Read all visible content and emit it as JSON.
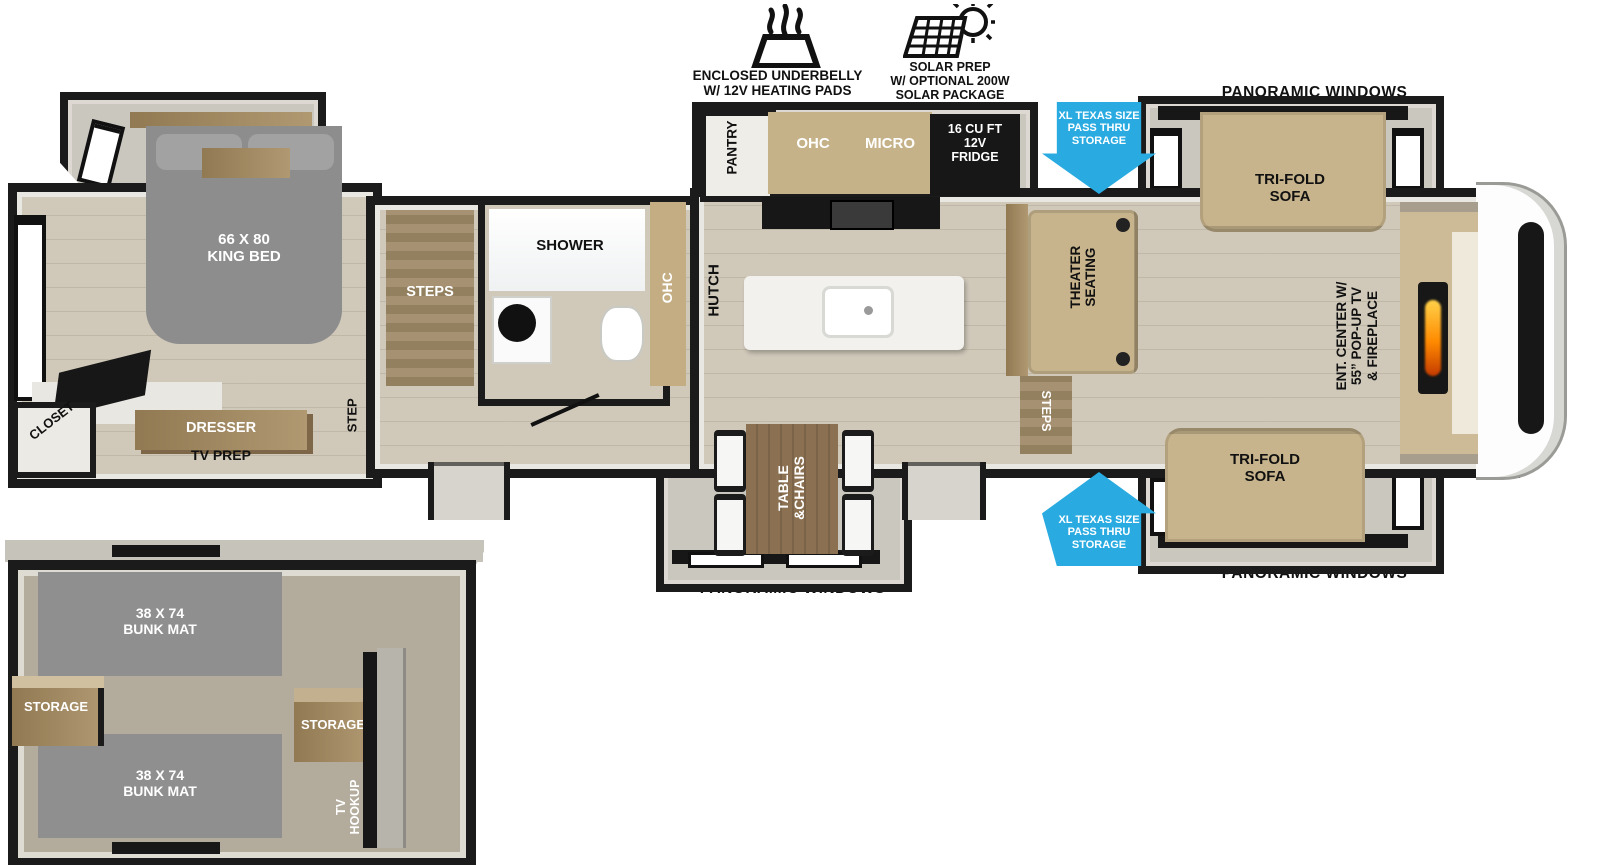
{
  "header": {
    "underbelly_label": "ENCLOSED UNDERBELLY\nW/ 12V HEATING PADS",
    "solar_label": "SOLAR PREP\nW/ OPTIONAL 200W\nSOLAR PACKAGE"
  },
  "callouts": {
    "pass_thru_top": "XL TEXAS SIZE\nPASS THRU\nSTORAGE",
    "pass_thru_bottom": "XL TEXAS SIZE\nPASS THRU\nSTORAGE",
    "panoramic_windows_top": "PANORAMIC WINDOWS",
    "panoramic_windows_bottom_right": "PANORAMIC WINDOWS",
    "panoramic_windows_dinette": "PANORAMIC WINDOWS"
  },
  "living": {
    "sofa_top": "TRI-FOLD\nSOFA",
    "sofa_bottom": "TRI-FOLD\nSOFA",
    "theater_seating": "THEATER\nSEATING",
    "steps": "STEPS",
    "ent_center": "ENT. CENTER W/\n55” POP-UP TV\n& FIREPLACE"
  },
  "kitchen": {
    "pantry": "PANTRY",
    "ohc": "OHC",
    "micro": "MICRO",
    "fridge": "16 CU FT\n12V\nFRIDGE",
    "hutch": "HUTCH"
  },
  "bath": {
    "shower": "SHOWER",
    "ohc": "OHC",
    "steps": "STEPS"
  },
  "bedroom": {
    "bed": "66 X 80\nKING BED",
    "closet": "CLOSET",
    "dresser": "DRESSER",
    "tv_prep": "TV PREP",
    "step": "STEP"
  },
  "dinette": {
    "table": "TABLE\n&CHAIRS"
  },
  "bunkroom": {
    "bunk_top": "38 X 74\nBUNK MAT",
    "bunk_bottom": "38 X 74\nBUNK MAT",
    "storage_left": "STORAGE",
    "storage_right": "STORAGE",
    "tv_hookup": "TV\nHOOKUP"
  },
  "colors": {
    "arrow_blue": "#29ABE2",
    "wall_black": "#1B1B1B",
    "flame_orange": "#FF8A00",
    "furniture_tan": "#C8B48C",
    "bed_gray": "#8D8D8D"
  }
}
